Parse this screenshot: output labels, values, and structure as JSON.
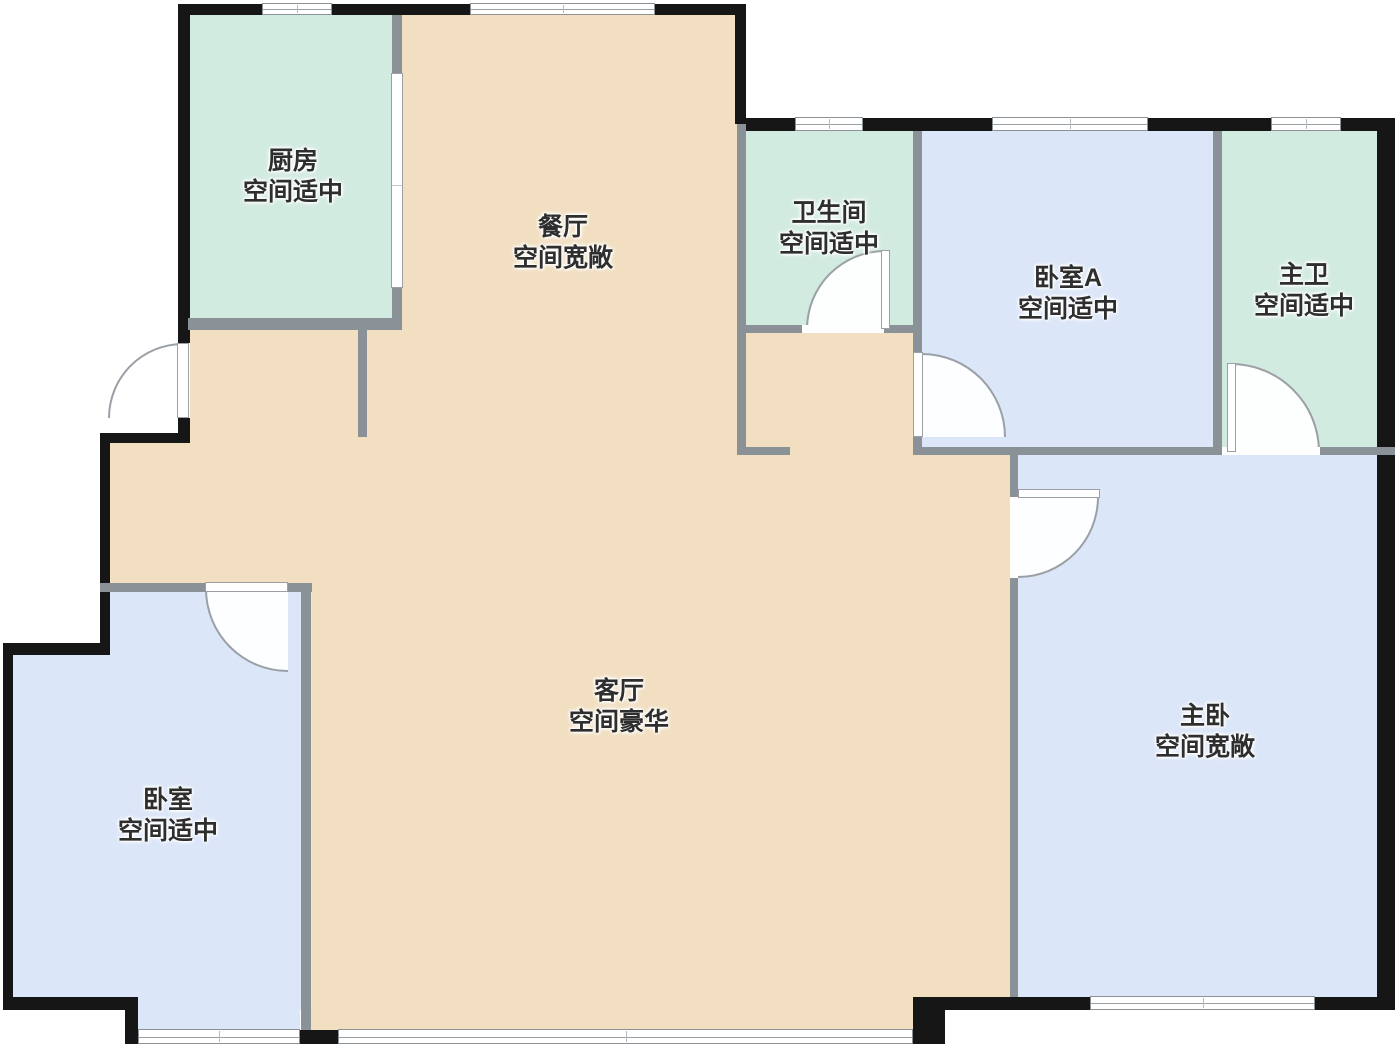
{
  "plan_title": "apartment-floor-plan",
  "colors": {
    "room_tan": "#f2dfc2",
    "room_mint": "#d2ebe0",
    "room_blue": "#dbe6f8",
    "wall_exterior": "#161616",
    "wall_interior": "#8a9197",
    "door_arc": "#9aa0a6",
    "label_text": "#2e2e2e"
  },
  "rooms": [
    {
      "id": "kitchen",
      "name": "厨房",
      "size_note": "空间适中"
    },
    {
      "id": "dining",
      "name": "餐厅",
      "size_note": "空间宽敞"
    },
    {
      "id": "bathroom",
      "name": "卫生间",
      "size_note": "空间适中"
    },
    {
      "id": "bedroom-a",
      "name": "卧室A",
      "size_note": "空间适中"
    },
    {
      "id": "master-bath",
      "name": "主卫",
      "size_note": "空间适中"
    },
    {
      "id": "living-room",
      "name": "客厅",
      "size_note": "空间豪华"
    },
    {
      "id": "bedroom",
      "name": "卧室",
      "size_note": "空间适中"
    },
    {
      "id": "master-bedroom",
      "name": "主卧",
      "size_note": "空间宽敞"
    }
  ]
}
